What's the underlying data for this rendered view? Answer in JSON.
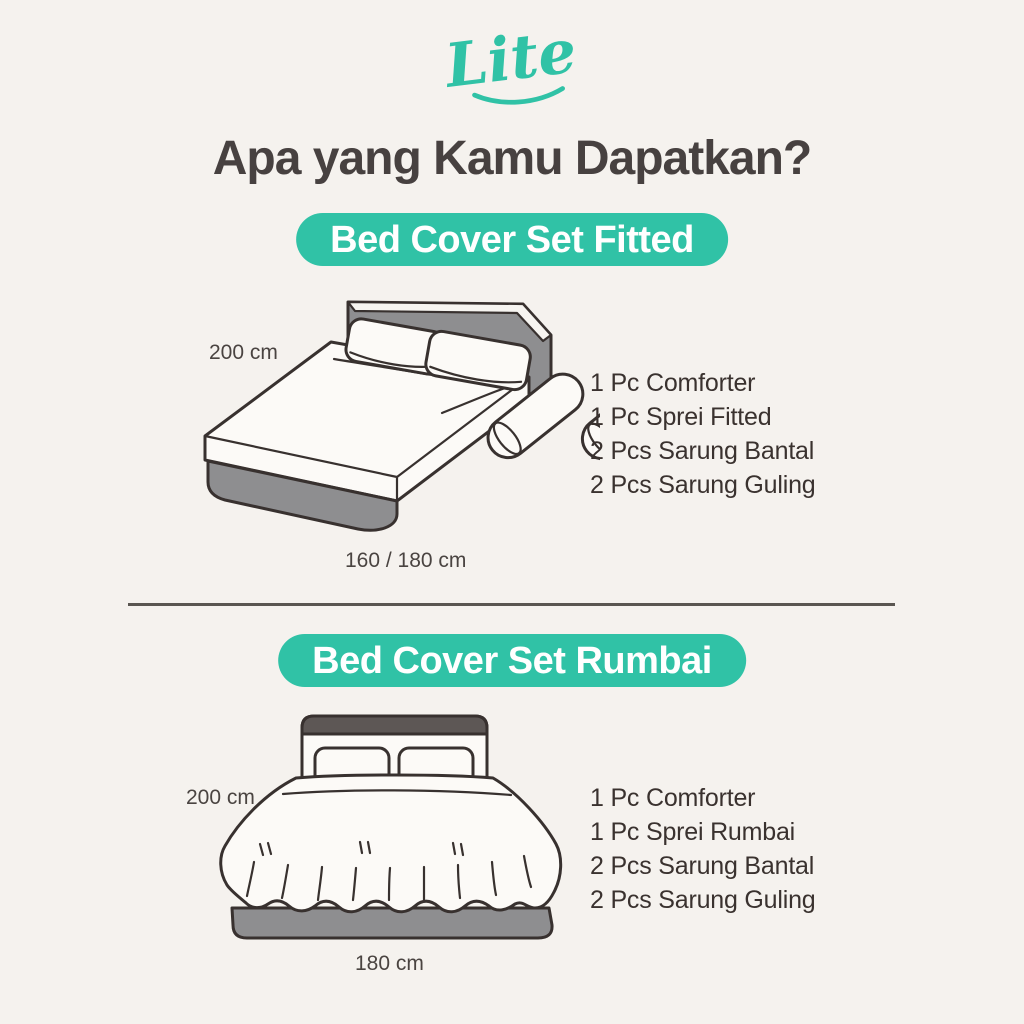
{
  "logo": {
    "text": "Lite"
  },
  "header": {
    "title": "Apa yang Kamu Dapatkan?"
  },
  "sections": [
    {
      "badge_label": "Bed Cover Set Fitted",
      "height_label": "200 cm",
      "width_label": "160 / 180 cm",
      "items": [
        "1 Pc Comforter",
        "1 Pc Sprei Fitted",
        "2 Pcs Sarung Bantal",
        "2 Pcs Sarung Guling"
      ]
    },
    {
      "badge_label": "Bed Cover Set Rumbai",
      "height_label": "200 cm",
      "width_label": "180 cm",
      "items": [
        "1 Pc Comforter",
        "1 Pc Sprei Rumbai",
        "2 Pcs Sarung Bantal",
        "2 Pcs Sarung Guling"
      ]
    }
  ],
  "colors": {
    "accent": "#30c2a6",
    "badge_text": "#ffffff",
    "background": "#f5f2ee",
    "title": "#474140",
    "body_text": "#3a322f",
    "outline": "#38312f",
    "gray_fill": "#8e8e90",
    "divider": "#5a5651"
  }
}
